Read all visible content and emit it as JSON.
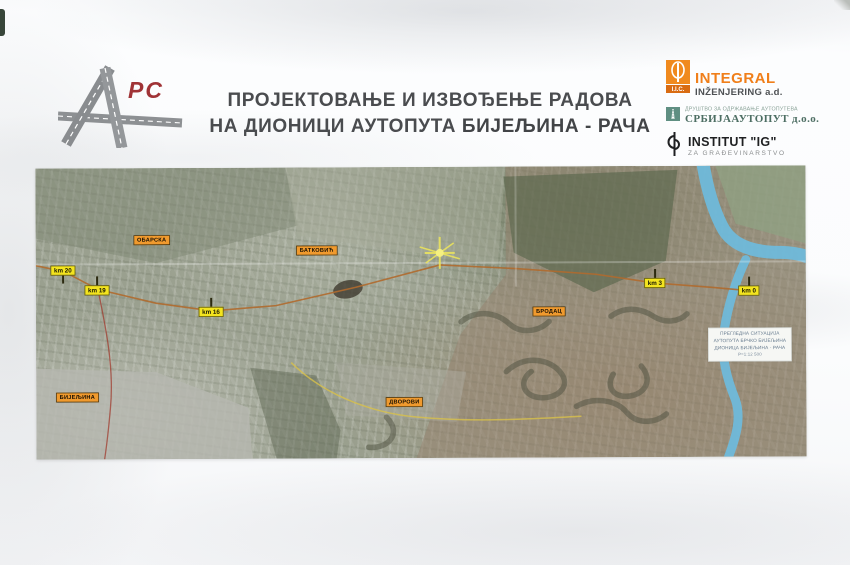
{
  "banner": {
    "logo": {
      "suffix": "РС"
    },
    "title": {
      "line1": "ПРОЈЕКТОВАЊЕ И ИЗВОЂЕЊЕ РАДОВА",
      "line2_prefix": "НА ДИОНИЦИ АУТОПУТА ",
      "line2_bold": "БИЈЕЉИНА - РАЧА"
    },
    "partners": {
      "integral": {
        "badge": "I.I.C.",
        "name": "INTEGRAL",
        "sub": "INŽENJERING a.d."
      },
      "srbijaautoput": {
        "tagline": "ДРУШТВО ЗА ОДРЖАВАЊЕ АУТОПУТЕВА",
        "name": "СРБИЈААУТОПУТ д.о.о."
      },
      "institut": {
        "name": "INSTITUT \"IG\"",
        "sub": "ZA GRAĐEVINARSTVO"
      }
    }
  },
  "map": {
    "towns": [
      {
        "label": "ОБАРСКА"
      },
      {
        "label": "БАТКОВИЋ"
      },
      {
        "label": "БРОДАЦ"
      },
      {
        "label": "ДВОРОВИ"
      },
      {
        "label": "БИЈЕЉИНА"
      }
    ],
    "km_markers": [
      {
        "label": "km 20"
      },
      {
        "label": "km 19"
      },
      {
        "label": "km 16"
      },
      {
        "label": "km 3"
      },
      {
        "label": "km 0"
      }
    ],
    "info_box": {
      "lines": [
        "ПРЕГЛЕДНА СИТУАЦИЈА",
        "АУТОПУТА БРЧКО БИЈЕЉИНА",
        "ДИОНИЦА БИЈЕЉИНА - РАЧА",
        "Р=1:12 500"
      ]
    }
  },
  "colors": {
    "accent_orange": "#f07f1a",
    "town_label_bg": "#f09a2e",
    "km_label_bg": "#f3e41f",
    "river_blue": "#6fb9da",
    "logo_red": "#a03336",
    "teal_green": "#5f8f82"
  }
}
